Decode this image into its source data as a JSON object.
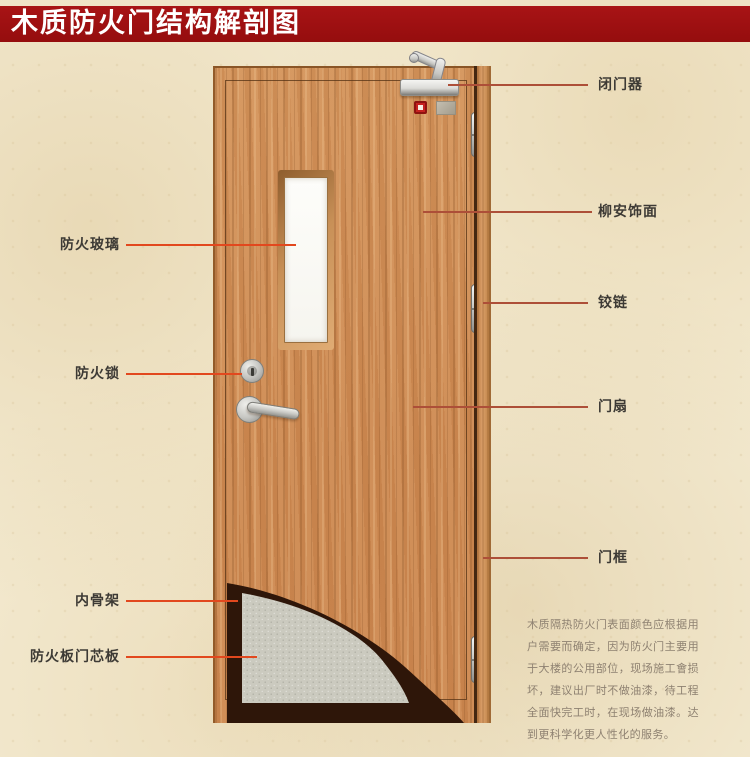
{
  "title": "木质防火门结构解剖图",
  "callouts": {
    "left": [
      {
        "text": "防火玻璃"
      },
      {
        "text": "防火锁"
      },
      {
        "text": "内骨架"
      },
      {
        "text": "防火板门芯板"
      }
    ],
    "right": [
      {
        "text": "闭门器"
      },
      {
        "text": "柳安饰面"
      },
      {
        "text": "铰链"
      },
      {
        "text": "门扇"
      },
      {
        "text": "门框"
      }
    ]
  },
  "description": "木质隔热防火门表面颜色应根据用户需要而确定，因为防火门主要用于大楼的公用部位，现场施工會损坏，建议出厂时不做油漆，待工程全面快完工时，在现场做油漆。达到更科学化更人性化的服务。",
  "colors": {
    "banner_red": "#9c0f10",
    "callout_line_left": "#e2481e",
    "callout_line_right": "#ad4f38",
    "wood": "#cd8c58",
    "core_board": "#cbcabf",
    "inner_skeleton": "#2e1609",
    "background": "#f4ebd2"
  }
}
